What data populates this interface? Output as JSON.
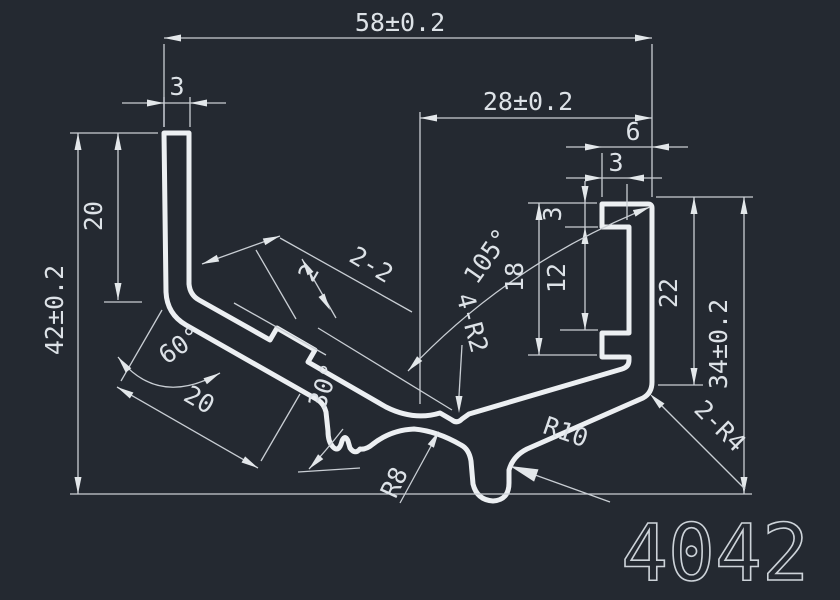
{
  "drawing": {
    "part_number": "4042",
    "colors": {
      "background": "#242931",
      "profile_line": "#eceff2",
      "dimension_line": "#c9ced4",
      "text": "#dde2e7"
    },
    "dims": {
      "total_width": "58±0.2",
      "inner_width": "28±0.2",
      "left_wall_thickness": "3",
      "right_slot_depth": "6",
      "right_lip_width": "3",
      "left_height": "42±0.2",
      "left_leg_length": "20",
      "right_lip_height": "3",
      "channel_inner_height": "18",
      "slot_opening": "12",
      "right_channel_height": "22",
      "right_height": "34±0.2",
      "slant_leg_length": "20",
      "left_angle": "60°",
      "slant_angle": "30°",
      "v_angle": "105°",
      "step_thickness": "2",
      "step_note": "2-2",
      "corner_radii": "4-R2",
      "bottom_radius": "R8",
      "valley_radius": "R10",
      "right_corner_radii": "2-R4"
    }
  }
}
